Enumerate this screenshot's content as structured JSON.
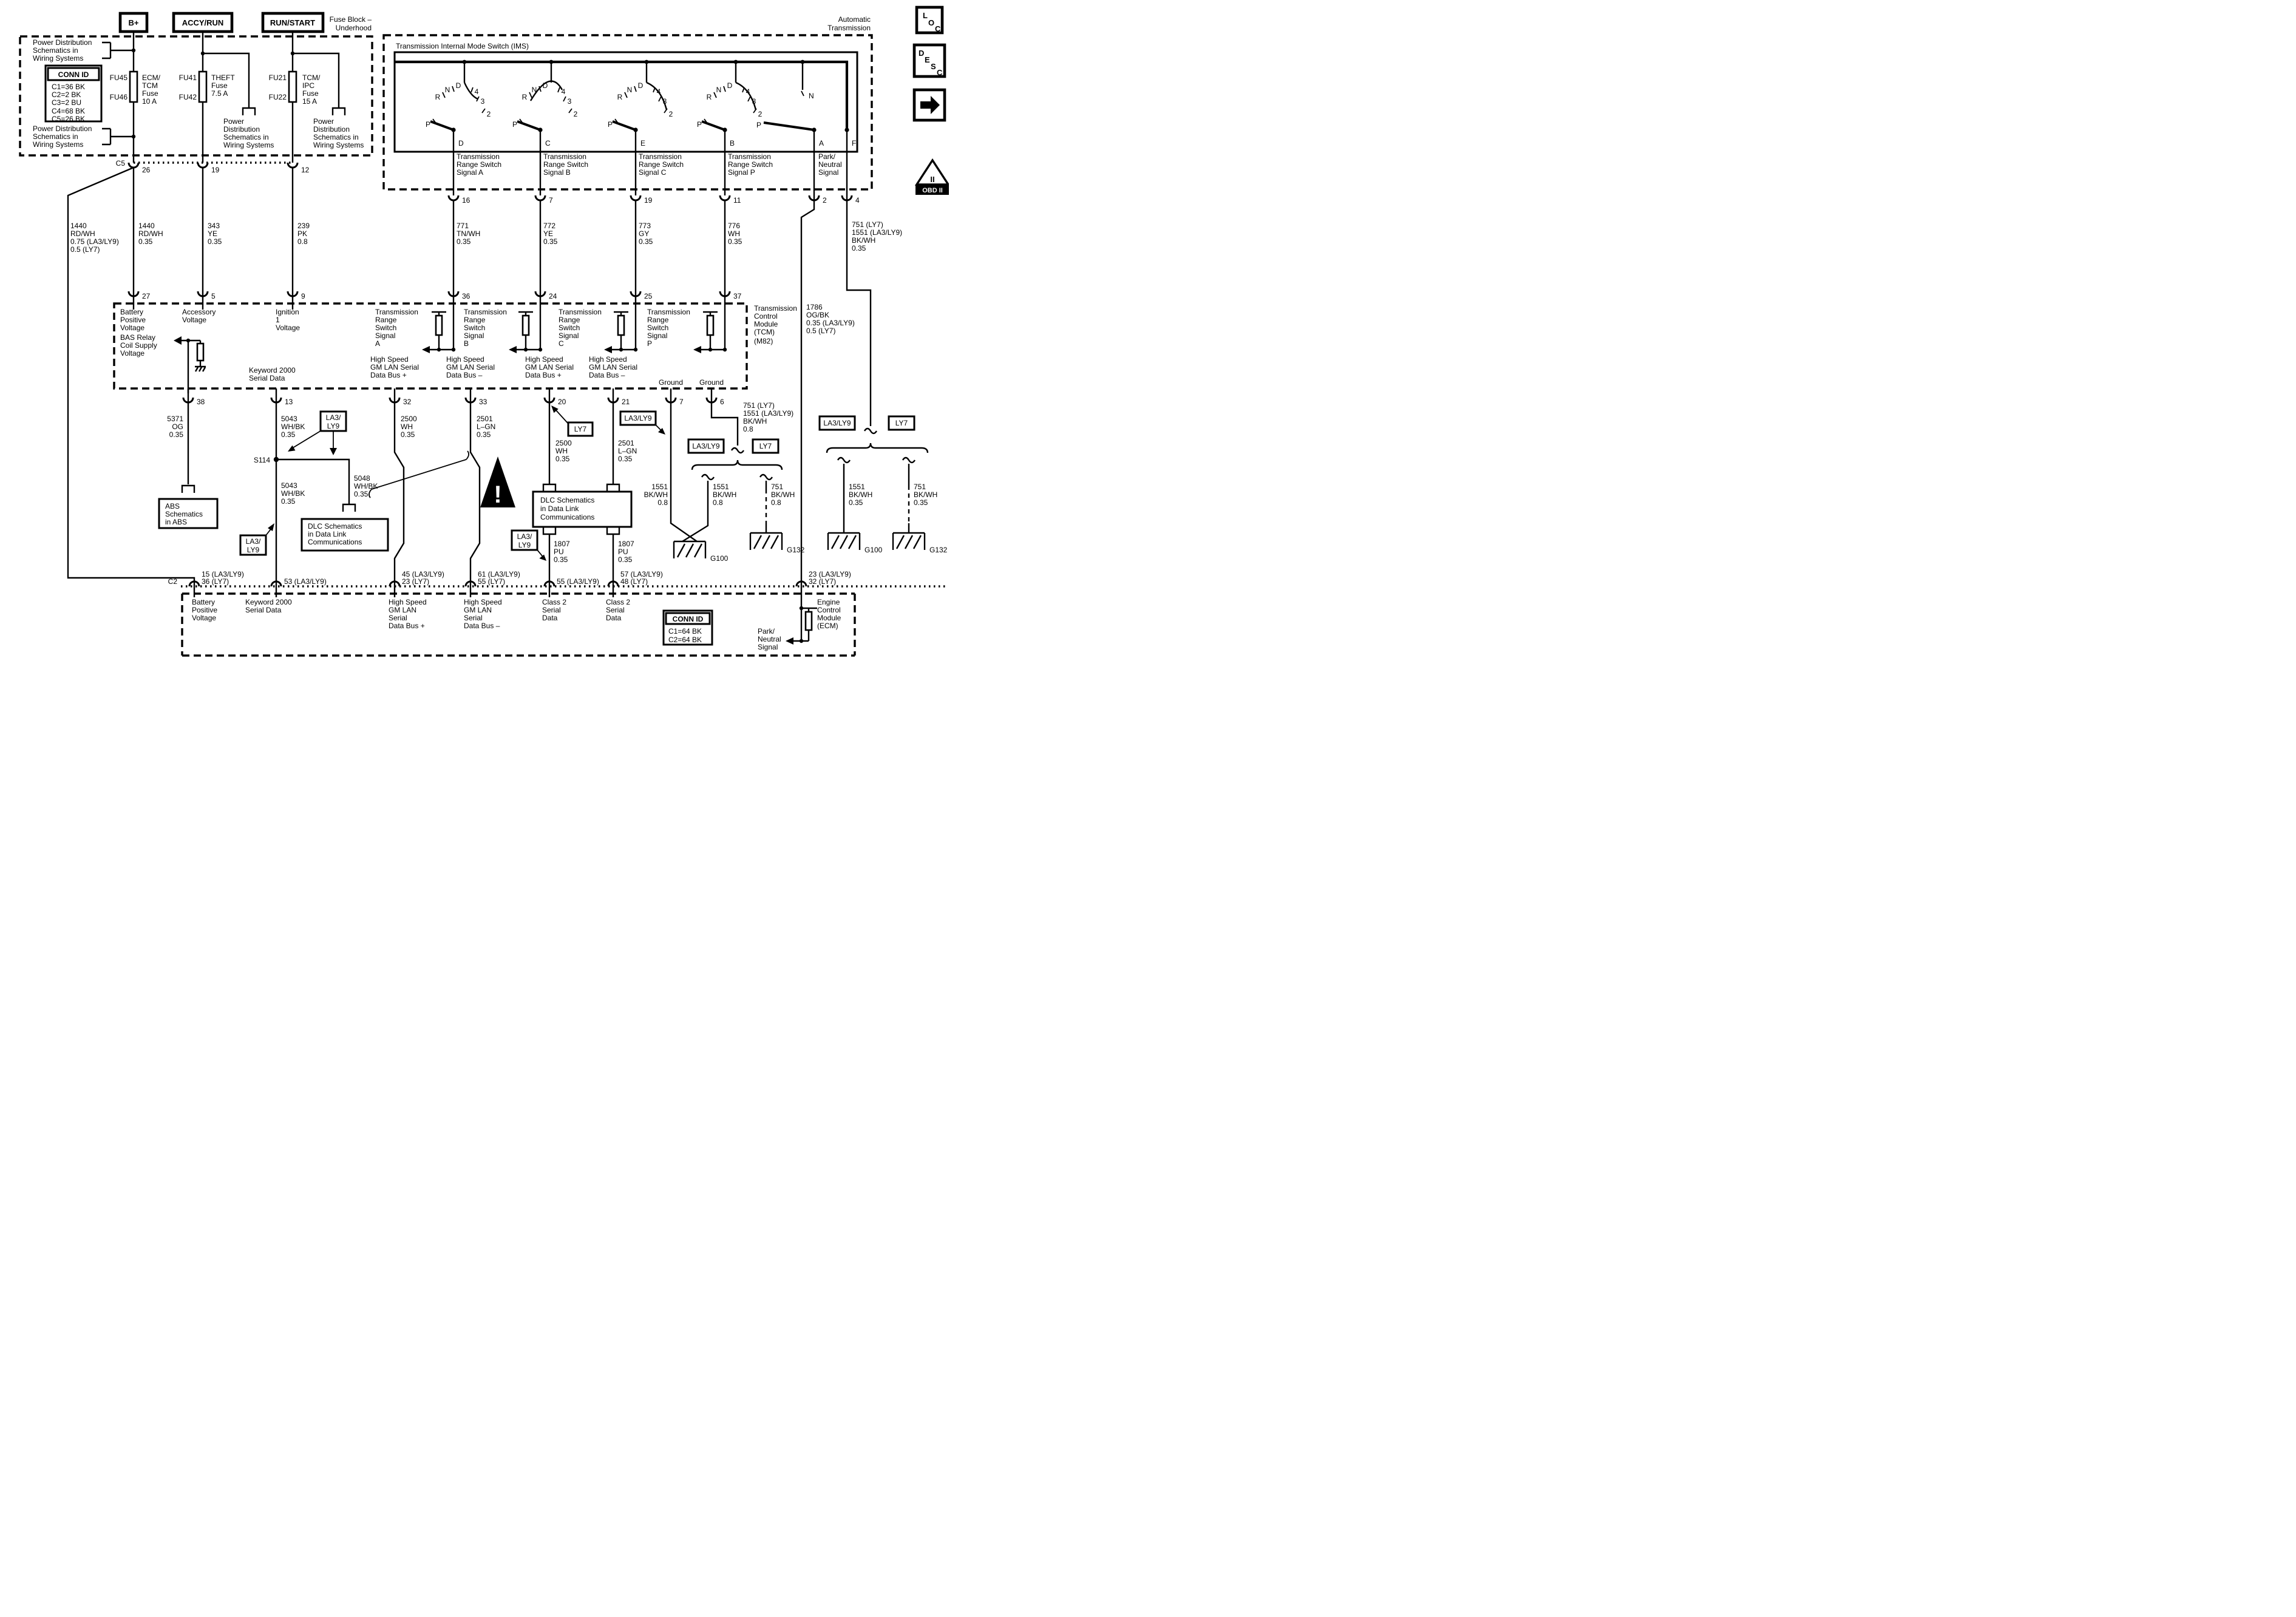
{
  "rails": {
    "b": "B+",
    "accy": "ACCY/RUN",
    "run": "RUN/START"
  },
  "captions": {
    "fuse_block": [
      "Fuse Block –",
      "Underhood"
    ],
    "auto": [
      "Automatic",
      "Transmission"
    ]
  },
  "fusebox": {
    "pd3a": [
      "Power Distribution",
      "Schematics in",
      "Wiring Systems"
    ],
    "pd3b": [
      "Power Distribution",
      "Schematics in",
      "Wiring Systems"
    ],
    "pd4a": [
      "Power",
      "Distribution",
      "Schematics in",
      "Wiring Systems"
    ],
    "pd4b": [
      "Power",
      "Distribution",
      "Schematics in",
      "Wiring Systems"
    ],
    "conn": {
      "title": "CONN ID",
      "rows": [
        "C1=36 BK",
        "C2=2 BK",
        "C3=2 BU",
        "C4=68 BK",
        "C5=26 BK"
      ]
    },
    "f1": {
      "a": "FU45",
      "b": "FU46",
      "name": [
        "ECM/",
        "TCM",
        "Fuse",
        "10 A"
      ]
    },
    "f2": {
      "a": "FU41",
      "b": "FU42",
      "name": [
        "THEFT",
        "Fuse",
        "7.5 A"
      ]
    },
    "f3": {
      "a": "FU21",
      "b": "FU22",
      "name": [
        "TCM/",
        "IPC",
        "Fuse",
        "15 A"
      ]
    }
  },
  "c5": {
    "name": "C5",
    "p26": "26",
    "p19": "19",
    "p12": "12"
  },
  "ims": {
    "title": "Transmission Internal Mode Switch (IMS)",
    "letters": {
      "p": "P",
      "r": "R",
      "n": "N",
      "d": "D",
      "n4": "4",
      "n3": "3",
      "n2": "2"
    },
    "term": [
      "D",
      "C",
      "E",
      "B",
      "A",
      "F"
    ],
    "sig": [
      [
        "Transmission",
        "Range Switch",
        "Signal A"
      ],
      [
        "Transmission",
        "Range Switch",
        "Signal B"
      ],
      [
        "Transmission",
        "Range Switch",
        "Signal C"
      ],
      [
        "Transmission",
        "Range Switch",
        "Signal P"
      ]
    ],
    "park": [
      "Park/",
      "Neutral",
      "Signal"
    ],
    "pins": [
      "16",
      "7",
      "19",
      "11",
      "2",
      "4"
    ]
  },
  "tcm": {
    "pt": [
      "27",
      "5",
      "9",
      "36",
      "24",
      "25",
      "37"
    ],
    "pb": [
      "38",
      "13",
      "32",
      "33",
      "20",
      "21",
      "7",
      "6"
    ],
    "batt": [
      "Battery",
      "Positive",
      "Voltage"
    ],
    "acc": [
      "Accessory",
      "Voltage"
    ],
    "ign": [
      "Ignition",
      "1",
      "Voltage"
    ],
    "bas": [
      "BAS Relay",
      "Coil Supply",
      "Voltage"
    ],
    "kw": [
      "Keyword 2000",
      "Serial Data"
    ],
    "sig": [
      [
        "Transmission",
        "Range",
        "Switch",
        "Signal",
        "A"
      ],
      [
        "Transmission",
        "Range",
        "Switch",
        "Signal",
        "B"
      ],
      [
        "Transmission",
        "Range",
        "Switch",
        "Signal",
        "C"
      ],
      [
        "Transmission",
        "Range",
        "Switch",
        "Signal",
        "P"
      ]
    ],
    "lan": [
      [
        "High Speed",
        "GM LAN Serial",
        "Data Bus +"
      ],
      [
        "High Speed",
        "GM LAN Serial",
        "Data Bus –"
      ],
      [
        "High Speed",
        "GM LAN Serial",
        "Data Bus +"
      ],
      [
        "High Speed",
        "GM LAN Serial",
        "Data Bus –"
      ]
    ],
    "gnd": "Ground",
    "name": [
      "Transmission",
      "Control",
      "Module",
      "(TCM)",
      "(M82)"
    ]
  },
  "wires": {
    "w1440L": [
      "1440",
      "RD/WH",
      "0.75 (LA3/LY9)",
      "0.5 (LY7)"
    ],
    "w1440": [
      "1440",
      "RD/WH",
      "0.35"
    ],
    "w343": [
      "343",
      "YE",
      "0.35"
    ],
    "w239": [
      "239",
      "PK",
      "0.8"
    ],
    "w771": [
      "771",
      "TN/WH",
      "0.35"
    ],
    "w772": [
      "772",
      "YE",
      "0.35"
    ],
    "w773": [
      "773",
      "GY",
      "0.35"
    ],
    "w776": [
      "776",
      "WH",
      "0.35"
    ],
    "w751p4": [
      "751 (LY7)",
      "1551 (LA3/LY9)",
      "BK/WH",
      "0.35"
    ],
    "w1786": [
      "1786",
      "OG/BK",
      "0.35 (LA3/LY9)",
      "0.5 (LY7)"
    ],
    "w5371": [
      "5371",
      "OG",
      "0.35"
    ],
    "w5043a": [
      "5043",
      "WH/BK",
      "0.35"
    ],
    "w5043b": [
      "5043",
      "WH/BK",
      "0.35"
    ],
    "w5048": [
      "5048",
      "WH/BK",
      "0.35"
    ],
    "w2500a": [
      "2500",
      "WH",
      "0.35"
    ],
    "w2501a": [
      "2501",
      "L–GN",
      "0.35"
    ],
    "w2500b": [
      "2500",
      "WH",
      "0.35"
    ],
    "w2501b": [
      "2501",
      "L–GN",
      "0.35"
    ],
    "w1807a": [
      "1807",
      "PU",
      "0.35"
    ],
    "w1807b": [
      "1807",
      "PU",
      "0.35"
    ],
    "w751p6": [
      "751 (LY7)",
      "1551 (LA3/LY9)",
      "BK/WH",
      "0.8"
    ],
    "w1551a": [
      "1551",
      "BK/WH",
      "0.8"
    ],
    "w1551b": [
      "1551",
      "BK/WH",
      "0.8"
    ],
    "w751a": [
      "751",
      "BK/WH",
      "0.8"
    ],
    "w1551c": [
      "1551",
      "BK/WH",
      "0.35"
    ],
    "w751b": [
      "751",
      "BK/WH",
      "0.35"
    ]
  },
  "badges": {
    "la": "LA3/LY9",
    "la1": "LA3/",
    "la2": "LY9",
    "ly": "LY7"
  },
  "splice": "S114",
  "gnd": {
    "g100": "G100",
    "g132": "G132"
  },
  "refs": {
    "abs": [
      "ABS",
      "Schematics",
      "in ABS"
    ],
    "dlc": [
      "DLC Schematics",
      "in Data Link",
      "Communications"
    ],
    "dlc2": [
      "DLC Schematics",
      "in Data Link",
      "Communications"
    ]
  },
  "ecm": {
    "c2": "C2",
    "pl": [
      [
        "15 (LA3/LY9)",
        "36 (LY7)"
      ],
      [
        "53 (LA3/LY9)"
      ],
      [
        "45 (LA3/LY9)",
        "23 (LY7)"
      ],
      [
        "61 (LA3/LY9)",
        "55 (LY7)"
      ],
      [
        "55 (LA3/LY9)"
      ],
      [
        "57 (LA3/LY9)",
        "48 (LY7)"
      ],
      [
        "23 (LA3/LY9)",
        "32 (LY7)"
      ]
    ],
    "lbl": [
      [
        "Battery",
        "Positive",
        "Voltage"
      ],
      [
        "Keyword 2000",
        "Serial Data"
      ],
      [
        "High Speed",
        "GM LAN",
        "Serial",
        "Data Bus +"
      ],
      [
        "High Speed",
        "GM LAN",
        "Serial",
        "Data Bus –"
      ],
      [
        "Class 2",
        "Serial",
        "Data"
      ],
      [
        "Class 2",
        "Serial",
        "Data"
      ]
    ],
    "park": [
      "Park/",
      "Neutral",
      "Signal"
    ],
    "conn": {
      "title": "CONN ID",
      "rows": [
        "C1=64 BK",
        "C2=64 BK"
      ]
    },
    "name": [
      "Engine",
      "Control",
      "Module",
      "(ECM)"
    ]
  },
  "icons": {
    "loc": [
      "L",
      "O",
      "C"
    ],
    "desc": [
      "D",
      "E",
      "S",
      "C"
    ],
    "obd": {
      "tri": "II",
      "label": "OBD II"
    }
  }
}
